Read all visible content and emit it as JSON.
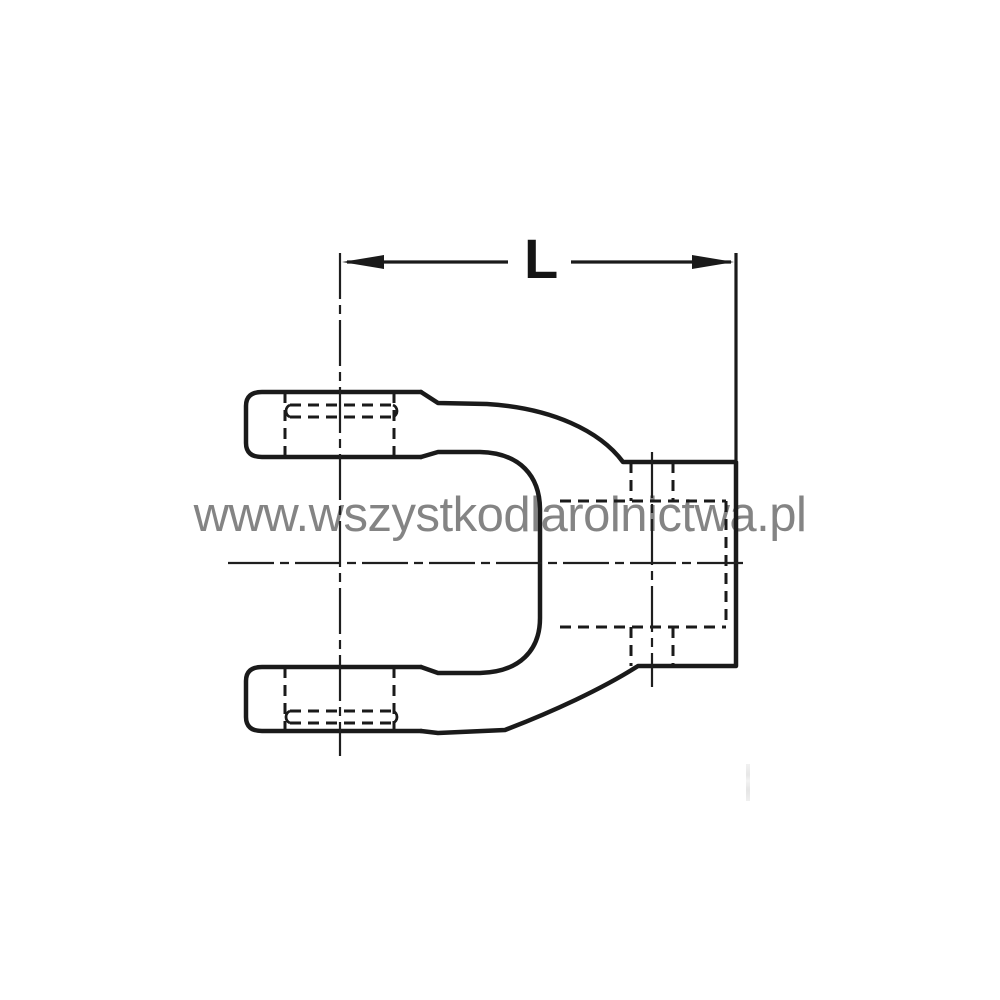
{
  "page": {
    "background_color": "#ffffff"
  },
  "drawing": {
    "subject": "Side-view technical line drawing of a PTO drive shaft yoke: two fork ears with hidden bore lines on the left, splined hub with hidden cross-hole lines on the right",
    "line_color": "#1a1a1a",
    "dimension_label": "L"
  },
  "watermark": {
    "text": "www.wszystkodlarolnictwa.pl",
    "color": "#7a7a7a"
  }
}
